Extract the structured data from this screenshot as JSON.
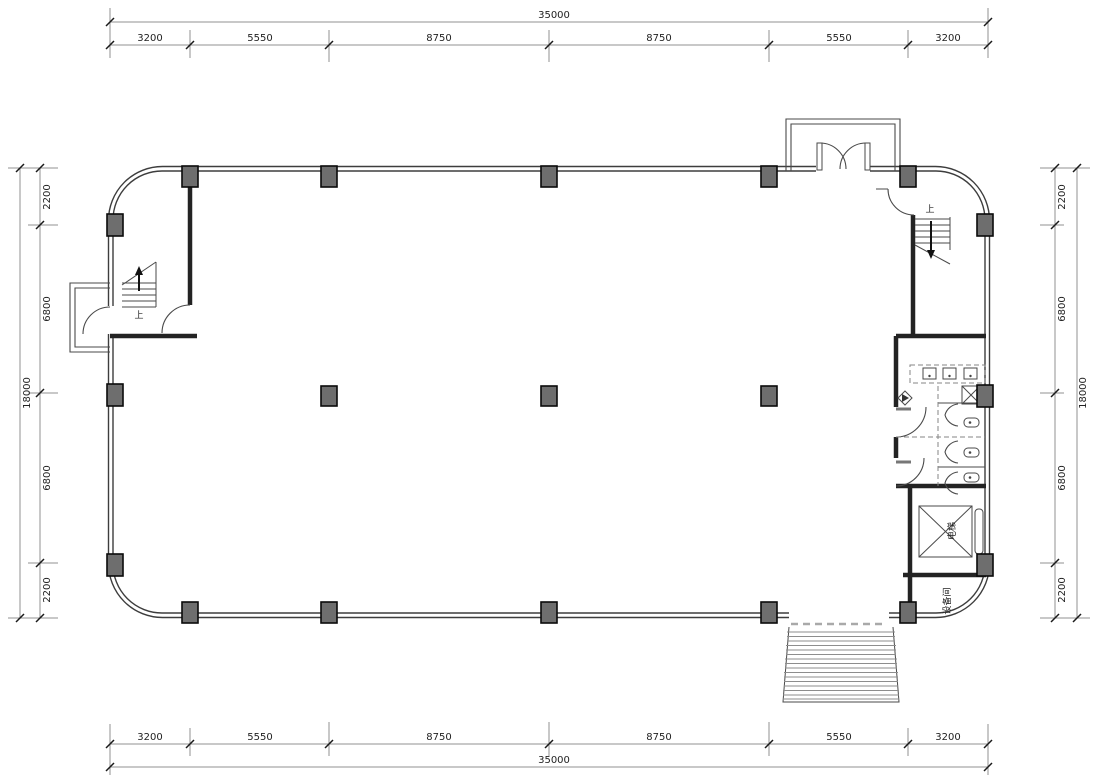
{
  "drawing": {
    "type": "architectural-floor-plan",
    "units": "mm",
    "colors": {
      "background": "#ffffff",
      "wall_line": "#3d3d3d",
      "interior_wall": "#232323",
      "column_fill": "#6e6e6e",
      "dimension_line": "#909090",
      "text": "#222222",
      "threshold_dash": "#a9a9a9"
    },
    "dimensions": {
      "top": {
        "total": "35000",
        "segments": [
          "3200",
          "5550",
          "8750",
          "8750",
          "5550",
          "3200"
        ]
      },
      "bottom": {
        "total": "35000",
        "segments": [
          "3200",
          "5550",
          "8750",
          "8750",
          "5550",
          "3200"
        ]
      },
      "left": {
        "total": "18000",
        "segments": [
          "2200",
          "6800",
          "6800",
          "2200"
        ]
      },
      "right": {
        "total": "18000",
        "segments": [
          "2200",
          "6800",
          "6800",
          "2200"
        ]
      }
    },
    "labels": {
      "stair_up_left": "上",
      "stair_up_right": "上",
      "elevator": "电梯",
      "room_bottom_right": "设备间"
    }
  }
}
